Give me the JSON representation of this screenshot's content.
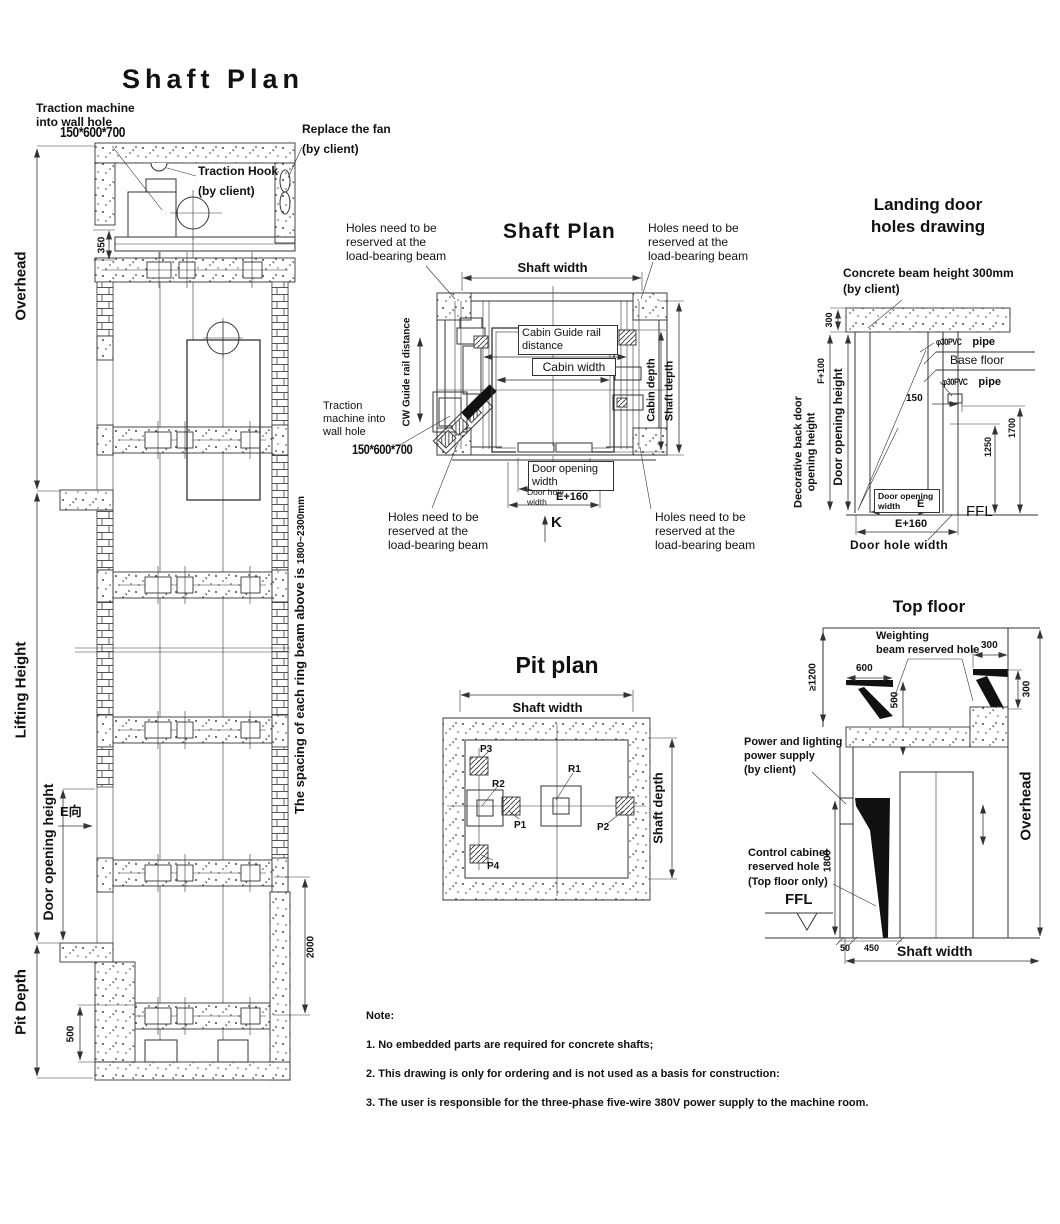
{
  "elevation": {
    "title": "Shaft Plan",
    "traction_machine_label": "Traction machine\ninto wall hole",
    "traction_machine_size": "150*600*700",
    "replace_fan_label": "Replace the fan\n\n(by client)",
    "traction_hook_label": "Traction Hook\n\n(by client)",
    "dim_350": "350",
    "overhead_label": "Overhead",
    "lifting_height_label": "Lifting Height",
    "door_opening_height_label": "Door opening height",
    "e_direction_label": "E向",
    "pit_depth_label": "Pit Depth",
    "dim_500": "500",
    "dim_2000": "2000",
    "ring_beam_note": "The spacing of each ring beam above is ",
    "ring_beam_spacing": "1800~2300mm"
  },
  "plan": {
    "title": "Shaft Plan",
    "holes_note": "Holes need to be\nreserved at the\nload-bearing beam",
    "shaft_width_label": "Shaft width",
    "cabin_guide_rail_label": "Cabin Guide rail\ndistance",
    "cabin_width_label": "Cabin width",
    "cw_guide_rail_label": "CW Guide rail distance",
    "cabin_depth_label": "Cabin depth",
    "shaft_depth_label": "Shaft depth",
    "traction_machine_label": "Traction\nmachine into\nwall hole",
    "traction_machine_size": "150*600*700",
    "door_opening_width_label": "Door opening\nwidth",
    "door_hole_width_label": "Door hole\nwidth",
    "door_hole_width_value": "E+160",
    "k_label": "K"
  },
  "pit": {
    "title": "Pit plan",
    "shaft_width_label": "Shaft width",
    "shaft_depth_label": "Shaft depth",
    "markers": {
      "p1": "P1",
      "p2": "P2",
      "p3": "P3",
      "p4": "P4",
      "r1": "R1",
      "r2": "R2"
    }
  },
  "landing": {
    "title": "Landing door\nholes drawing",
    "concrete_beam_note": "Concrete beam height 300mm\n(by client)",
    "dim_300": "300",
    "dim_f100": "F+100",
    "door_opening_height_label": "Door opening height",
    "decorative_label": "Decorative back door\nopening height",
    "pipe_size_1": "φ30PVC",
    "pipe_word_1": "pipe",
    "base_floor_label": "Base floor",
    "pipe_size_2": "φ30PVC",
    "pipe_word_2": "pipe",
    "dim_150": "150",
    "dim_1250": "1250",
    "dim_1700": "1700",
    "door_opening_width_label": "Door opening\nwidth",
    "dim_e": "E",
    "dim_e160": "E+160",
    "ffl_label": "FFL",
    "door_hole_width_label": "Door hole width"
  },
  "top_floor": {
    "title": "Top floor",
    "weighting_label": "Weighting\nbeam reserved hole",
    "dim_1200": "≥1200",
    "dim_600": "600",
    "dim_500": "500",
    "dim_300_w": "300",
    "dim_300_h": "300",
    "power_label": "Power and lighting\npower supply\n(by client)",
    "control_label": "Control cabinet\nreserved hole\n(Top floor only)",
    "dim_1800": "1800",
    "ffl_label": "FFL",
    "dim_50": "50",
    "dim_450": "450",
    "shaft_width_label": "Shaft width",
    "overhead_label": "Overhead"
  },
  "notes": {
    "heading": "Note:",
    "items": [
      "1. No embedded parts are required for concrete shafts;",
      "2. This drawing is only for ordering and is not used as a basis for construction:",
      "3. The user is responsible for the three-phase five-wire 380V power supply to the machine room."
    ]
  }
}
